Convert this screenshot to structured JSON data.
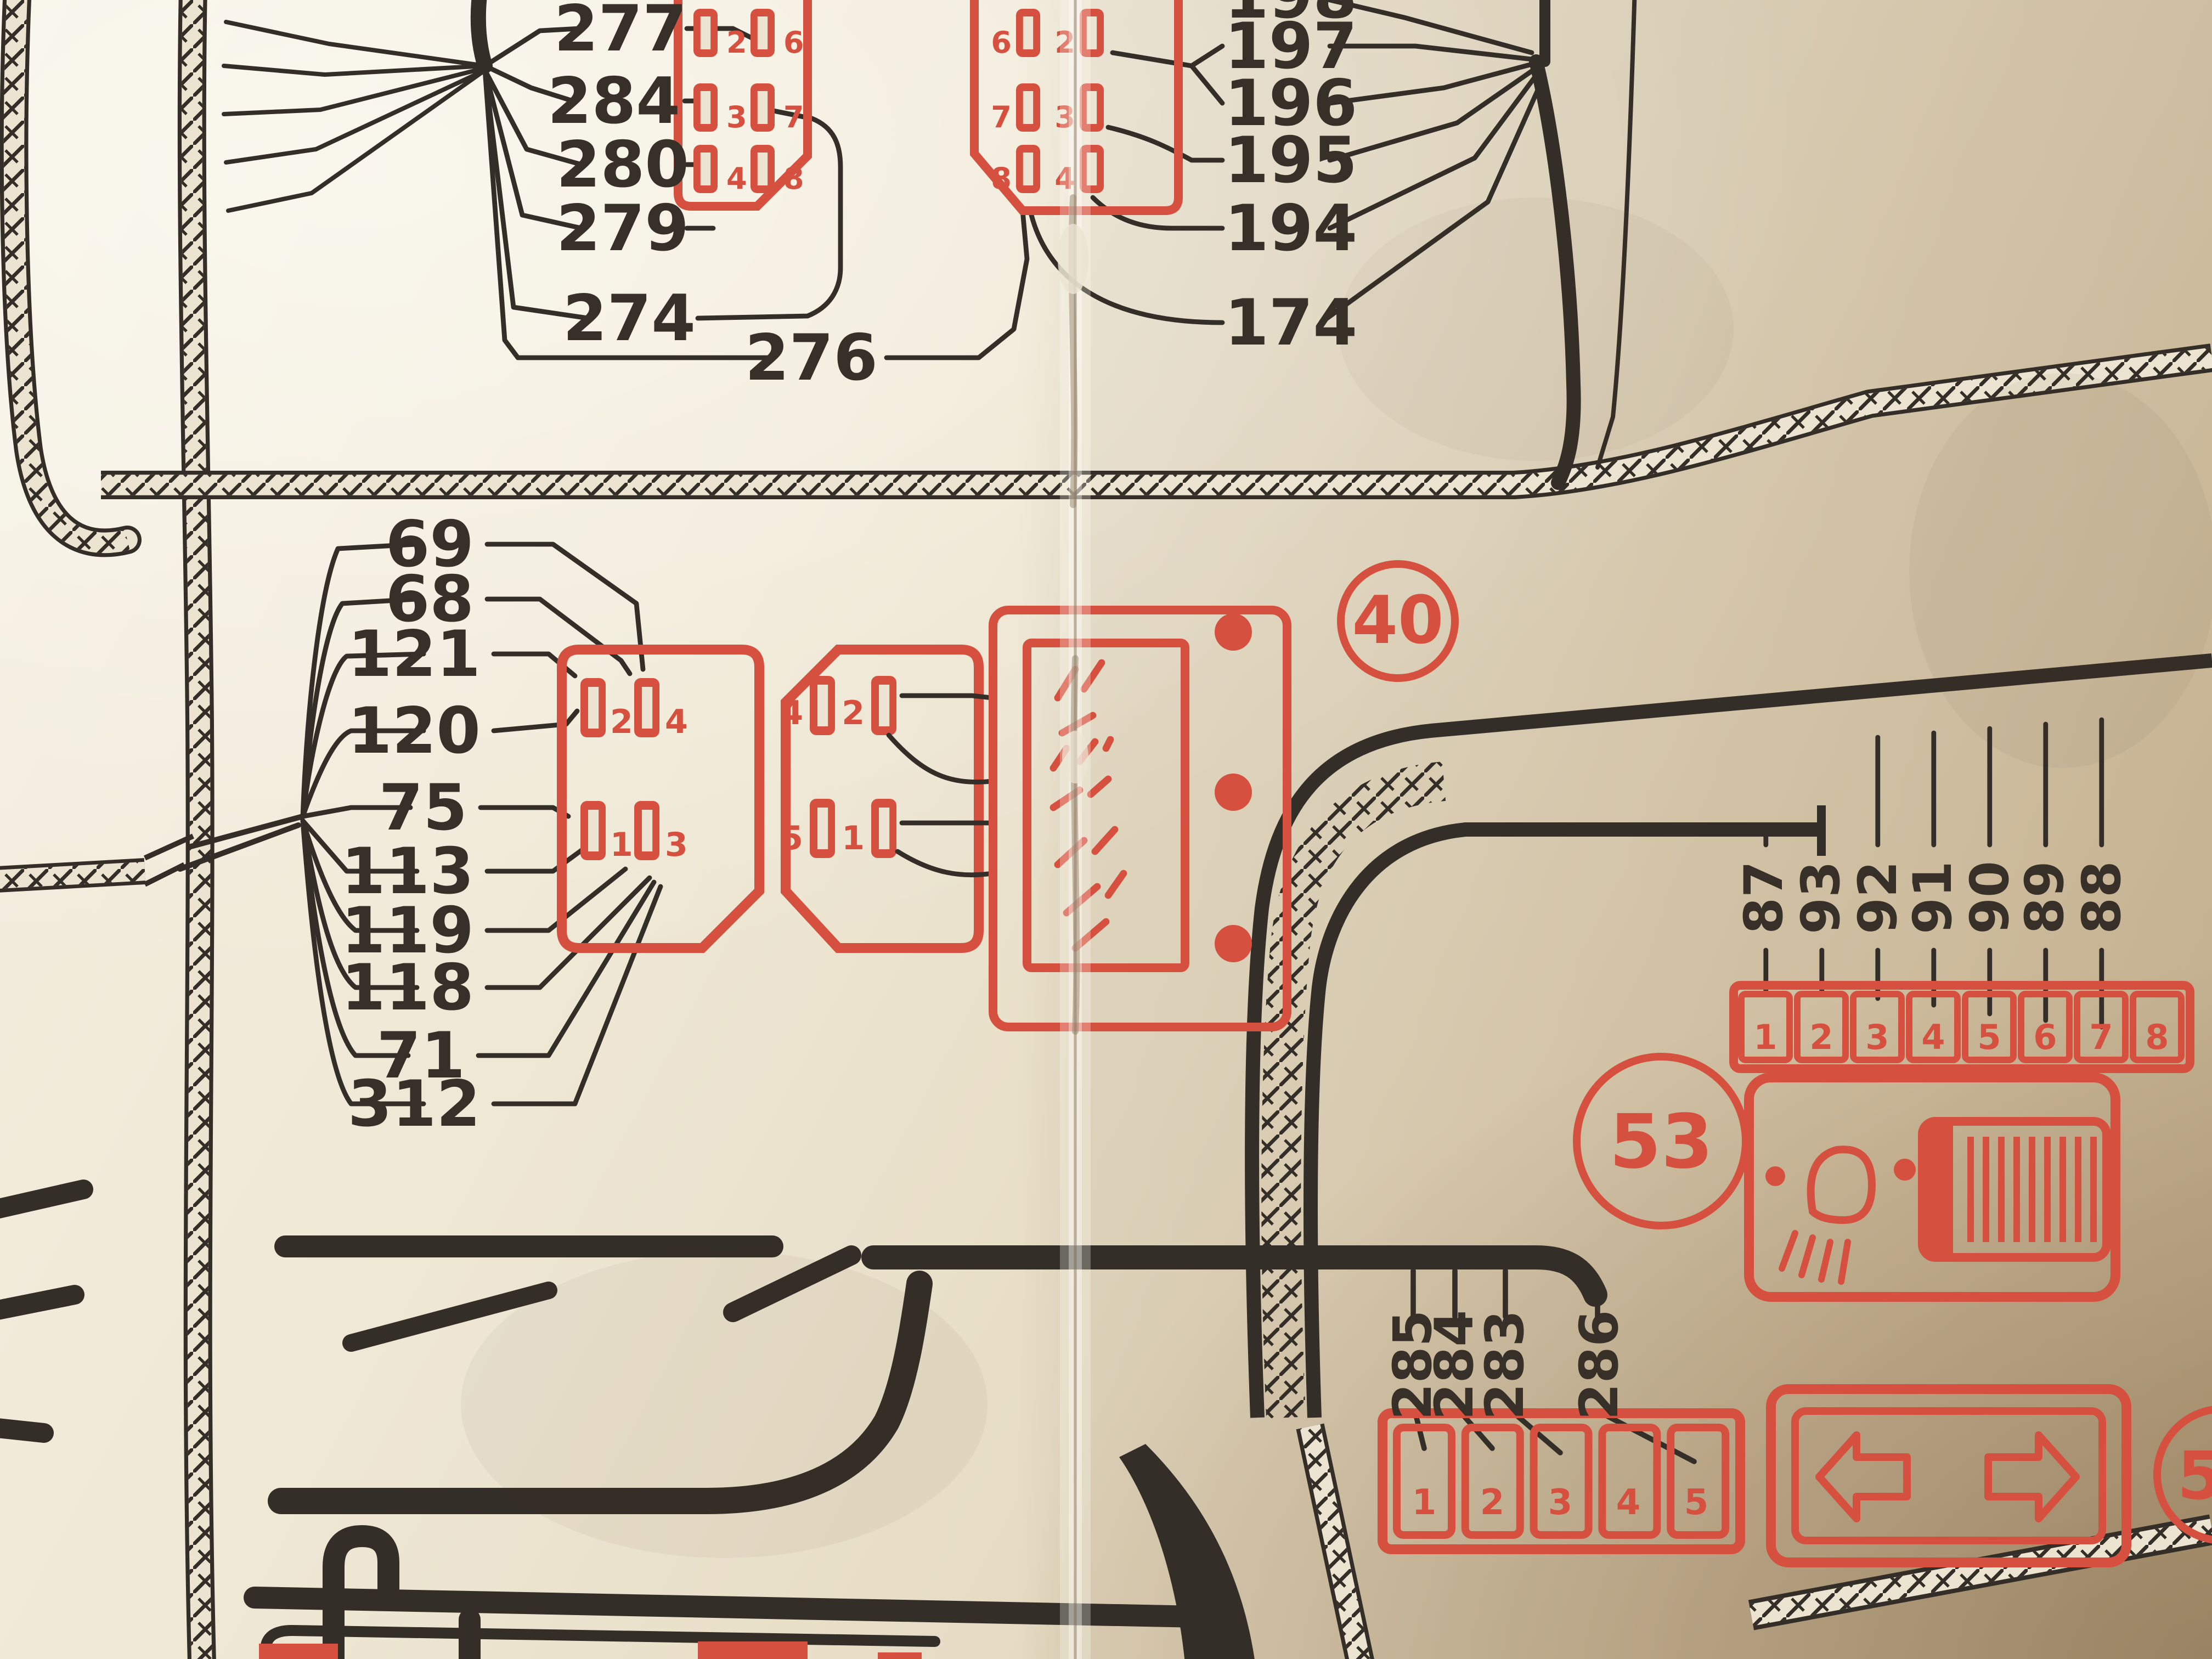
{
  "colors": {
    "red": "#d6503f",
    "black": "#332e27",
    "paper": "#ece4d0"
  },
  "component_badges": {
    "c40": "40",
    "c53": "53",
    "c54": "54"
  },
  "callout_groups": {
    "upper_left": {
      "labels": [
        "277",
        "284",
        "280",
        "279",
        "274",
        "276"
      ]
    },
    "upper_right": {
      "labels": [
        "198",
        "197",
        "196",
        "195",
        "194",
        "174"
      ]
    },
    "mid_left": {
      "labels": [
        "69",
        "68",
        "121",
        "120",
        "75",
        "113",
        "119",
        "118",
        "71",
        "312"
      ]
    },
    "bottom_center": {
      "labels": [
        "285",
        "284",
        "283",
        "286"
      ]
    },
    "right_rotated": {
      "labels": [
        "87",
        "93",
        "92",
        "91",
        "90",
        "89",
        "88"
      ]
    }
  },
  "connectors": {
    "top_left_connector": {
      "pin_labels": [
        "2",
        "3",
        "4",
        "6",
        "7",
        "8"
      ]
    },
    "top_right_connector": {
      "pin_labels": [
        "6",
        "7",
        "8",
        "2",
        "3",
        "4"
      ]
    },
    "mid_left_connector": {
      "pin_labels": [
        "2",
        "4",
        "1",
        "3"
      ]
    },
    "mid_right_connector": {
      "pin_labels": [
        "4",
        "2",
        "5",
        "1"
      ]
    },
    "pin_row_8": {
      "cells": [
        "1",
        "2",
        "3",
        "4",
        "5",
        "6",
        "7",
        "8"
      ]
    },
    "pin_row_5": {
      "cells": [
        "1",
        "2",
        "3",
        "4",
        "5"
      ]
    }
  },
  "icons": {
    "component_40": [
      "grille-marks-icon",
      "contact-dots-icon"
    ],
    "component_53": [
      "headlight-icon",
      "coil-icon"
    ],
    "component_54_box": [
      "arrow-left-icon",
      "arrow-right-icon"
    ]
  }
}
